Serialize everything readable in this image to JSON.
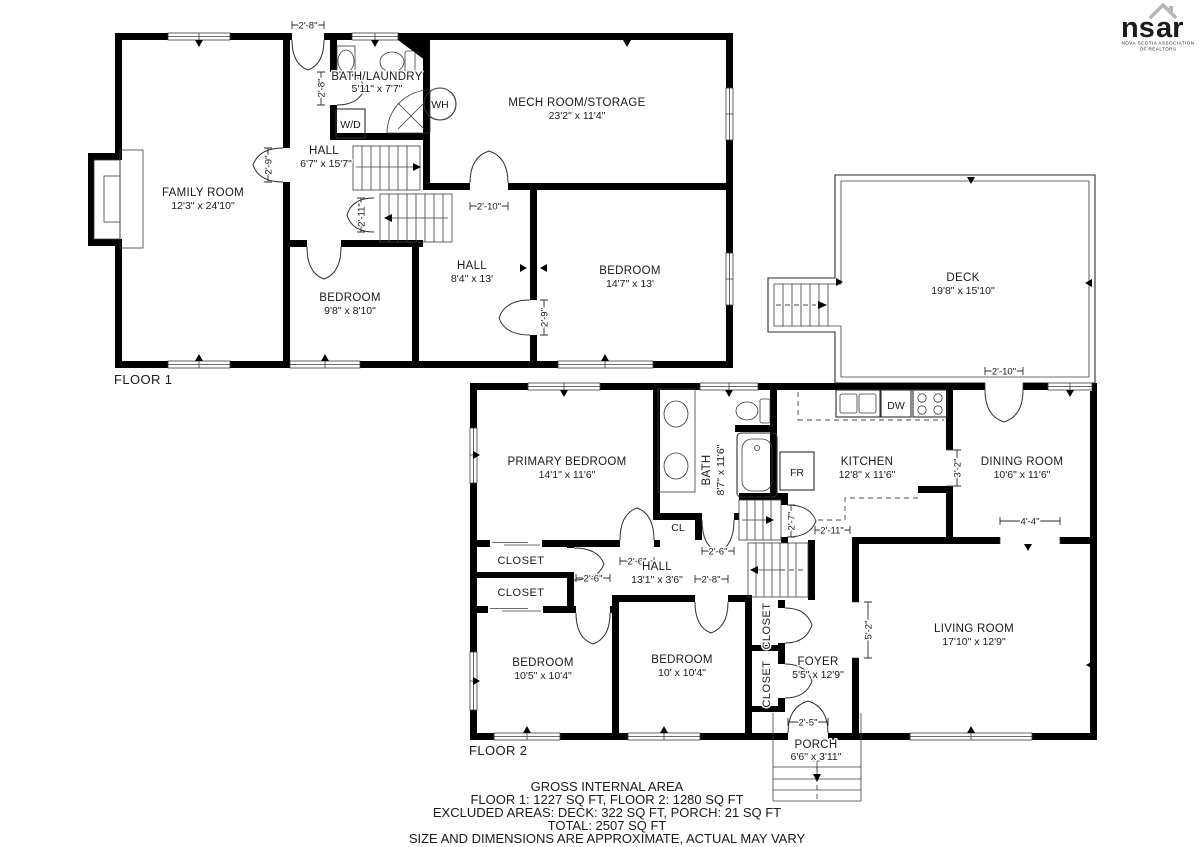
{
  "colors": {
    "wall": "#000000",
    "line": "#3a3a3a",
    "muted": "#9b9b9f",
    "logo": "#b7b7bb"
  },
  "logo": {
    "left": "ns",
    "right": "ar",
    "sub1": "NOVA SCOTIA ASSOCIATION",
    "sub2": "OF REALTORS"
  },
  "floor1": {
    "label": "FLOOR 1",
    "rooms": {
      "family": {
        "name": "FAMILY ROOM",
        "dims": "12'3\" x 24'10\""
      },
      "bath": {
        "name": "BATH/LAUNDRY",
        "dims": "5'11\" x 7'7\""
      },
      "mech": {
        "name": "MECH ROOM/STORAGE",
        "dims": "23'2\" x 11'4\""
      },
      "hall_upper": {
        "name": "HALL",
        "dims": "6'7\" x 15'7\""
      },
      "hall_lower": {
        "name": "HALL",
        "dims": "8'4\" x 13'"
      },
      "bedroom_small": {
        "name": "BEDROOM",
        "dims": "9'8\" x 8'10\""
      },
      "bedroom_large": {
        "name": "BEDROOM",
        "dims": "14'7\" x 13'"
      }
    },
    "fixtures": {
      "washer_dryer": "W/D",
      "water_heater": "WH"
    },
    "dims": {
      "entry": "2'-8\"",
      "bath_door": "2'-8\"",
      "family_door": "2'-9\"",
      "stair_door": "2'-11\"",
      "mech_door": "2'-10\"",
      "bedroom_door": "2'-9\""
    }
  },
  "deck": {
    "name": "DECK",
    "dims": "19'8\" x 15'10\""
  },
  "floor2": {
    "label": "FLOOR 2",
    "rooms": {
      "primary": {
        "name": "PRIMARY BEDROOM",
        "dims": "14'1\" x 11'6\""
      },
      "bath": {
        "name": "BATH",
        "dims": "8'7\" x 11'6\""
      },
      "kitchen": {
        "name": "KITCHEN",
        "dims": "12'8\" x 11'6\""
      },
      "dining": {
        "name": "DINING ROOM",
        "dims": "10'6\" x 11'6\""
      },
      "hall": {
        "name": "HALL",
        "dims": "13'1\" x 3'6\""
      },
      "bedroom_left": {
        "name": "BEDROOM",
        "dims": "10'5\" x 10'4\""
      },
      "bedroom_mid": {
        "name": "BEDROOM",
        "dims": "10' x 10'4\""
      },
      "foyer": {
        "name": "FOYER",
        "dims": "5'5\" x 12'9\""
      },
      "living": {
        "name": "LIVING ROOM",
        "dims": "17'10\" x 12'9\""
      },
      "porch": {
        "name": "PORCH",
        "dims": "6'6\" x 3'11\""
      }
    },
    "labels": {
      "closet1": "CLOSET",
      "closet2": "CLOSET",
      "closet3": "CLOSET",
      "closet4": "CLOSET",
      "cl": "CL",
      "fridge": "FR",
      "dishwasher": "DW"
    },
    "dims": {
      "deck_door": "2'-10\"",
      "primary_door": "2'-6\"",
      "bath_door": "2'-6\"",
      "bedroom3_door": "2'-6\"",
      "bedroom4_door": "2'-8\"",
      "stair_door": "2'-7\"",
      "kitchen_pass": "2'-11\"",
      "kitchen_open": "3'-2\"",
      "dining_open": "4'-4\"",
      "living_open": "5'-2\"",
      "front_door": "2'-5\""
    }
  },
  "footer": {
    "title": "GROSS INTERNAL AREA",
    "areas": "FLOOR 1: 1227 SQ FT, FLOOR 2: 1280 SQ FT",
    "excluded": "EXCLUDED AREAS: DECK: 322 SQ FT, PORCH: 21 SQ FT",
    "total": "TOTAL: 2507 SQ FT",
    "disclaimer": "SIZE AND DIMENSIONS ARE APPROXIMATE, ACTUAL MAY VARY"
  }
}
